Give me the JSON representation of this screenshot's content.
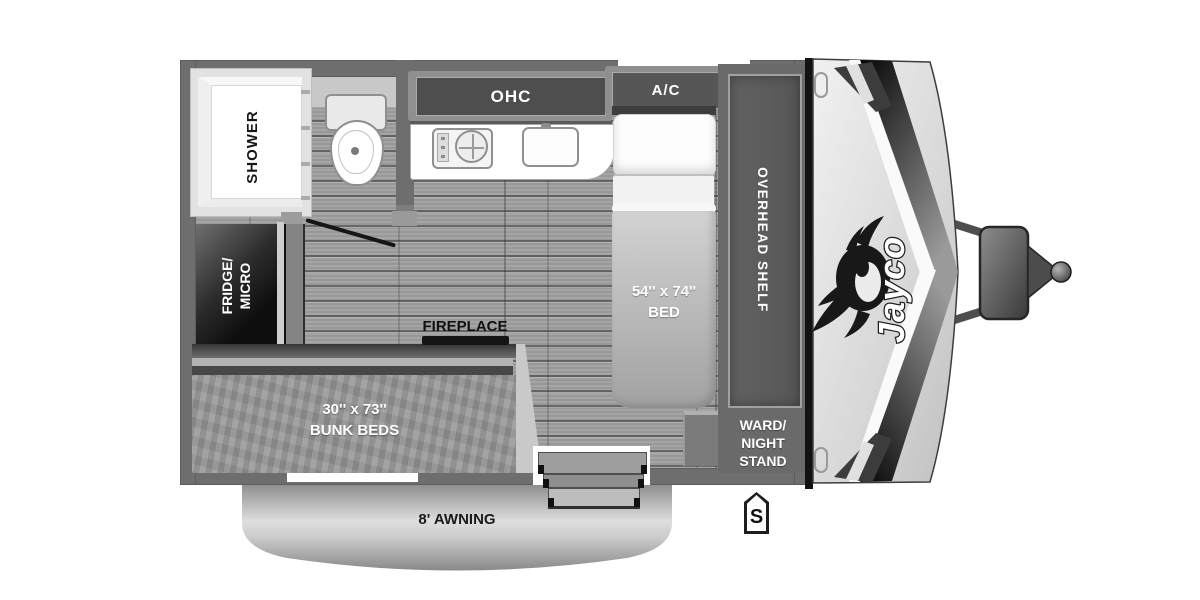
{
  "labels": {
    "brand": "Jayco",
    "shower": "SHOWER",
    "ohc": "OHC",
    "ac": "A/C",
    "fridge": {
      "line1": "FRIDGE/",
      "line2": "MICRO"
    },
    "fireplace": "FIREPLACE",
    "bed": {
      "line1": "54'' x 74''",
      "line2": "BED"
    },
    "overhead_shelf": "OVERHEAD SHELF",
    "ward": {
      "line1": "WARD/",
      "line2": "NIGHT",
      "line3": "STAND"
    },
    "bunk": {
      "line1": "30'' x 73''",
      "line2": "BUNK BEDS"
    },
    "awning": "8' AWNING",
    "spare": "S"
  },
  "colors": {
    "wall": "#6e6e6e",
    "floor": "#a0a0a0",
    "cabinet_dark": "#4e4e4e",
    "appliance_black": "#141414",
    "front_cap": "#d9d9d9",
    "label_light": "#ffffff",
    "label_dark": "#111111",
    "background": "#ffffff"
  }
}
